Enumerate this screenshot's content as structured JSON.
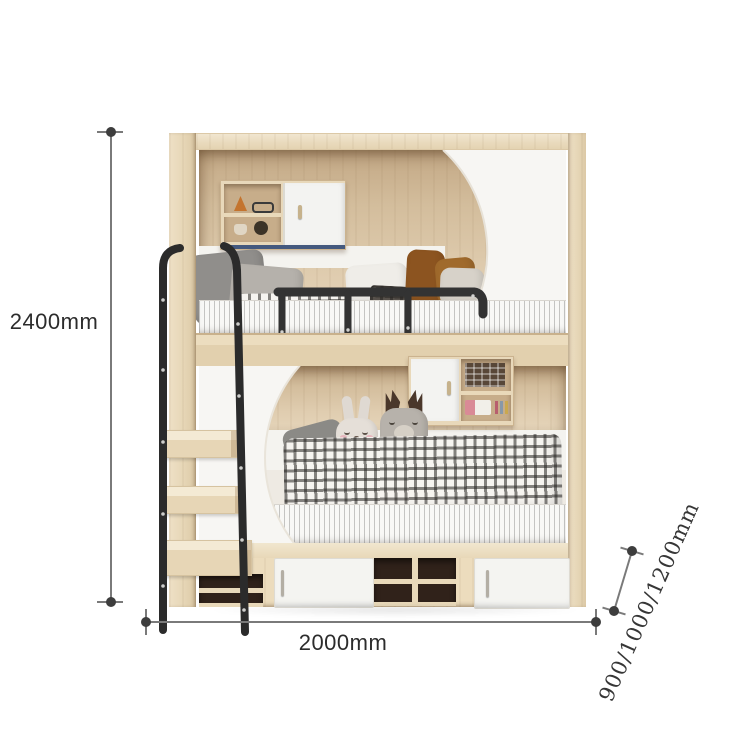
{
  "diagram": {
    "subject": "kids bunk bed with wardrobe cabinets, guardrail, ladder and storage drawers",
    "dimensions": {
      "height": "2400mm",
      "width": "2000mm",
      "depth": "900/1000/1200mm"
    }
  },
  "palette": {
    "wood_light": "#ebdcc0",
    "wood_mid": "#dcc7a6",
    "wood_interior": "#d3bd9c",
    "panel_white": "#f7f6f3",
    "metal_black": "#2b2b2b",
    "accent_blue": "#44597e",
    "accent_pink": "#e9aebc",
    "drawer_interior_dark": "#30221a",
    "dimension_gray": "#3d3d3d"
  }
}
